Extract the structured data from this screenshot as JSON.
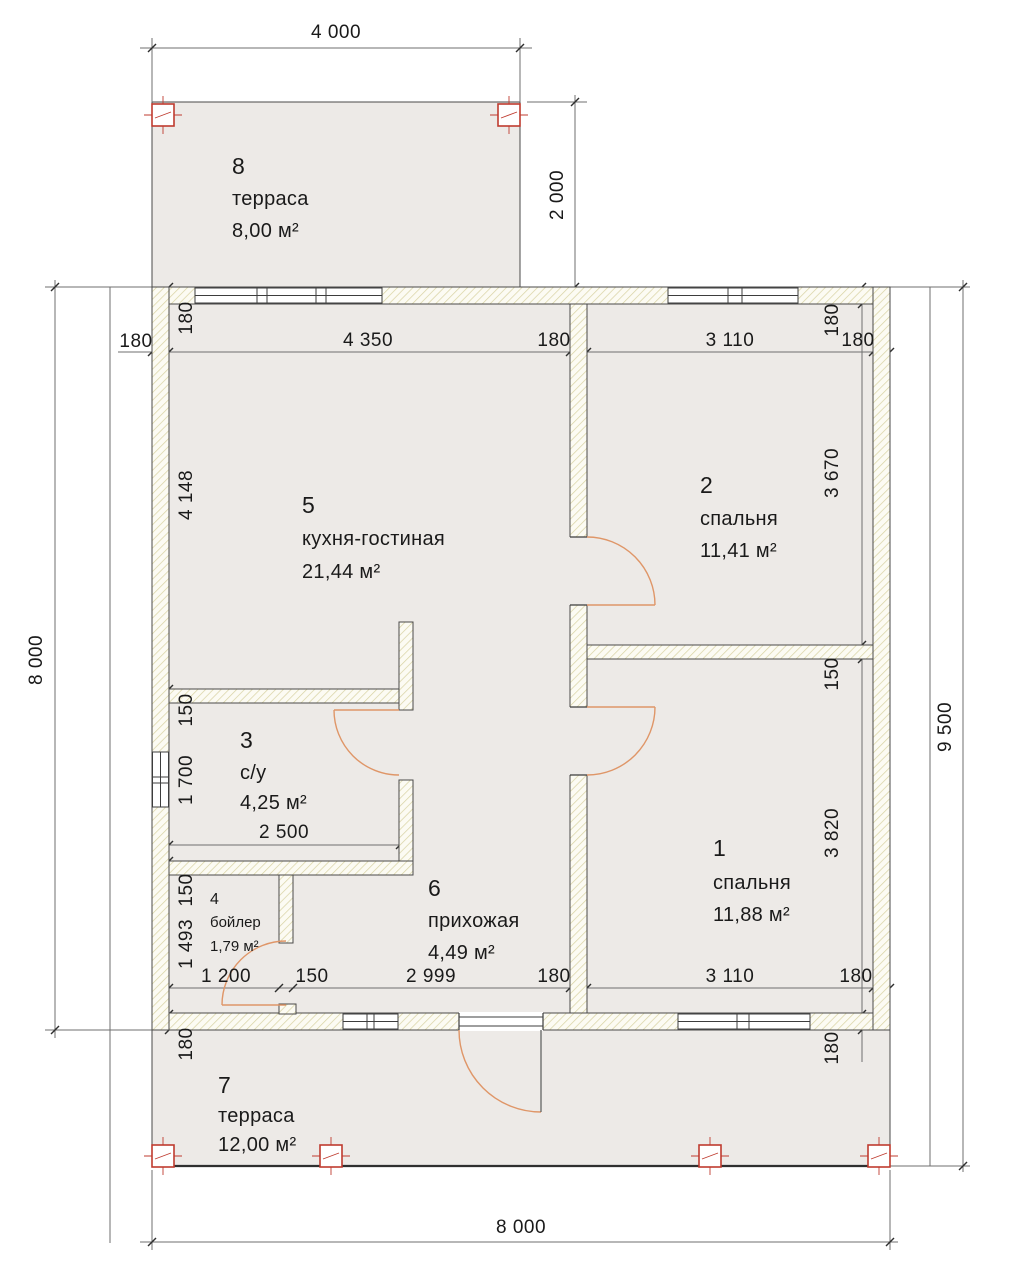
{
  "plan": {
    "kind": "floor-plan",
    "language": "ru"
  },
  "colors": {
    "floor_fill": "#edeae7",
    "wall_hatch": "#d8d2a2",
    "wall_background": "#fcfbf3",
    "outline": "#3c3c3c",
    "dimension_line": "#6f6f6f",
    "text": "#1a1a1a",
    "door_arc": "#df9668",
    "column_marker": "#bf3b2f"
  },
  "rooms": [
    {
      "number": "1",
      "name": "спальня",
      "area": "11,88 м²"
    },
    {
      "number": "2",
      "name": "спальня",
      "area": "11,41 м²"
    },
    {
      "number": "3",
      "name": "с/у",
      "area": "4,25 м²"
    },
    {
      "number": "4",
      "name": "бойлер",
      "area": "1,79 м²"
    },
    {
      "number": "5",
      "name": "кухня-гостиная",
      "area": "21,44 м²"
    },
    {
      "number": "6",
      "name": "прихожая",
      "area": "4,49 м²"
    },
    {
      "number": "7",
      "name": "терраса",
      "area": "12,00 м²"
    },
    {
      "number": "8",
      "name": "терраса",
      "area": "8,00 м²"
    }
  ],
  "dims": {
    "overall": {
      "terrace_top_width": "4 000",
      "terrace_top_depth": "2 000",
      "house_left_height": "8 000",
      "right_total_height": "9 500",
      "house_bottom_width": "8 000"
    },
    "top_chain": [
      "180",
      "4 350",
      "180",
      "3 110",
      "180"
    ],
    "left_chain": [
      "180",
      "4 148",
      "150",
      "1 700",
      "150",
      "1 493",
      "180"
    ],
    "right_chain": [
      "180",
      "3 670",
      "150",
      "3 820",
      "180"
    ],
    "bottom_chain": [
      "1 200",
      "150",
      "2 999",
      "180",
      "3 110",
      "180"
    ],
    "bathroom_width": "2 500"
  }
}
